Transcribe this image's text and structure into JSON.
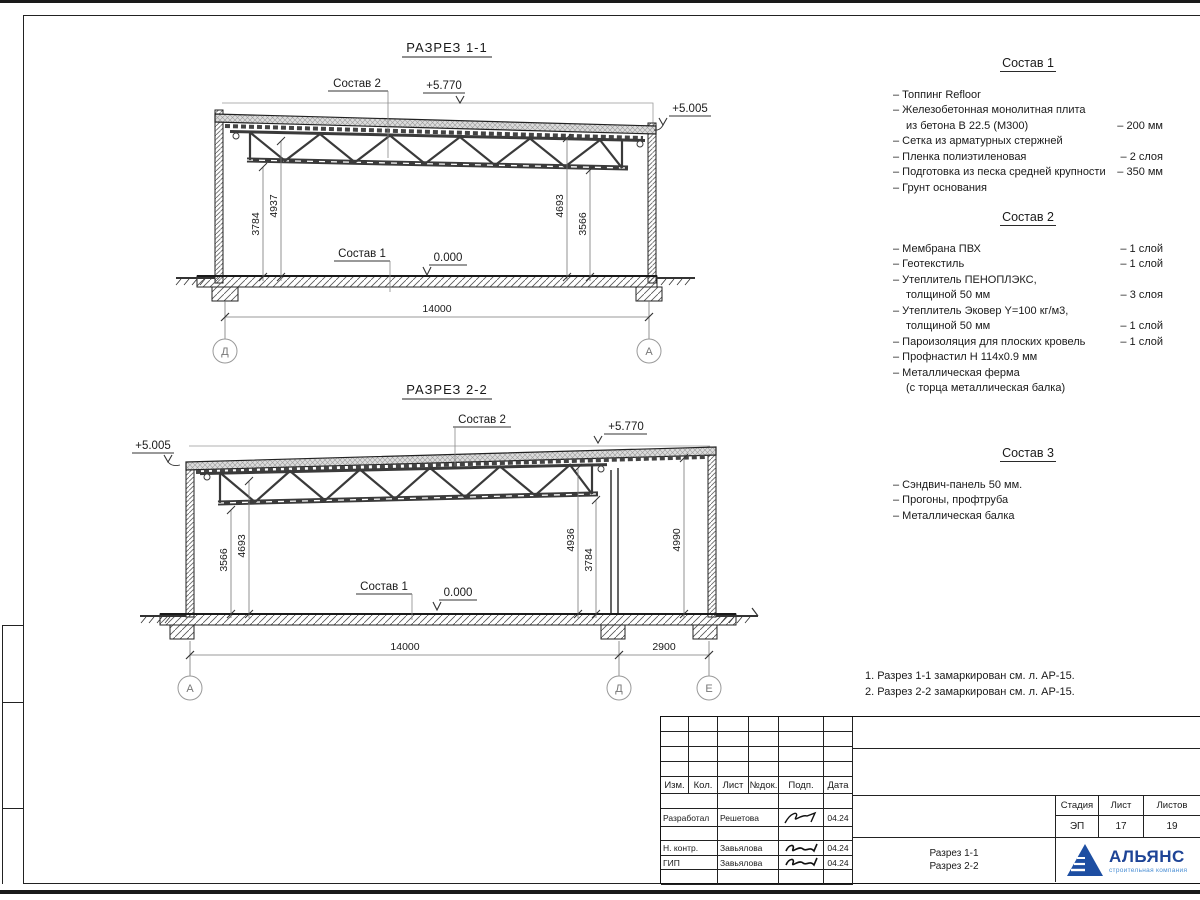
{
  "s1": {
    "title": "РАЗРЕЗ 1-1",
    "label_comp2": "Состав 2",
    "label_comp1": "Состав 1",
    "elev_top": "+5.770",
    "elev_eave": "+5.005",
    "elev_floor": "0.000",
    "dim_left_outer": "3784",
    "dim_left_inner": "4937",
    "dim_right_inner": "4693",
    "dim_right_outer": "3566",
    "dim_span": "14000",
    "axis_left": "Д",
    "axis_right": "А"
  },
  "s2": {
    "title": "РАЗРЕЗ 2-2",
    "label_comp2": "Состав 2",
    "label_comp1": "Состав 1",
    "elev_top": "+5.770",
    "elev_eave": "+5.005",
    "elev_floor": "0.000",
    "dim_left_outer": "3566",
    "dim_left_inner": "4693",
    "dim_mid_inner": "4936",
    "dim_mid_outer": "3784",
    "dim_right": "4990",
    "dim_span": "14000",
    "dim_span2": "2900",
    "axis_left": "А",
    "axis_mid": "Д",
    "axis_right": "Е"
  },
  "comp1": {
    "title": "Состав 1",
    "items": [
      {
        "l1": "– Топпинг Refloor"
      },
      {
        "l1": "– Железобетонная  монолитная плита",
        "l2": "из бетона В 22.5 (М300)",
        "v": "– 200 мм"
      },
      {
        "l1": "– Сетка из арматурных стержней"
      },
      {
        "l1": "– Пленка полиэтиленовая",
        "v": "– 2 слоя"
      },
      {
        "l1": "– Подготовка из песка средней крупности",
        "v": "– 350 мм"
      },
      {
        "l1": "– Грунт основания"
      }
    ]
  },
  "comp2": {
    "title": "Состав 2",
    "items": [
      {
        "l1": "– Мембрана ПВХ",
        "v": "– 1 слой"
      },
      {
        "l1": "– Геотекстиль",
        "v": "– 1 слой"
      },
      {
        "l1": "– Утеплитель ПЕНОПЛЭКС,",
        "l2": "толщиной 50 мм",
        "v": "– 3 слоя"
      },
      {
        "l1": "– Утеплитель Эковер Y=100 кг/м3,",
        "l2": "толщиной 50 мм",
        "v": "– 1 слой"
      },
      {
        "l1": "– Пароизоляция для плоских кровель",
        "v": "– 1 слой"
      },
      {
        "l1": "– Профнастил Н 114х0.9 мм"
      },
      {
        "l1": "– Металлическая ферма",
        "l2": "(с торца металлическая балка)"
      }
    ]
  },
  "comp3": {
    "title": "Состав 3",
    "items": [
      {
        "l1": "– Сэндвич-панель 50 мм."
      },
      {
        "l1": "– Прогоны, профтруба"
      },
      {
        "l1": "– Металлическая балка"
      }
    ]
  },
  "notes": {
    "items": [
      {
        "t": "1. Разрез 1-1 замаркирован см. л. АР-15."
      },
      {
        "t": "2. Разрез 2-2 замаркирован см. л. АР-15."
      }
    ]
  },
  "titleblock": {
    "header_cols": [
      "Изм.",
      "Кол.",
      "Лист",
      "№док.",
      "Подп.",
      "Дата"
    ],
    "rows": [
      {
        "role": "Разработал",
        "name": "Решетова",
        "date": "04.24"
      },
      {
        "role": "Н. контр.",
        "name": "Завьялова",
        "date": "04.24"
      },
      {
        "role": "ГИП",
        "name": "Завьялова",
        "date": "04.24"
      }
    ],
    "doc_title_line1": "Разрез 1-1",
    "doc_title_line2": "Разрез 2-2",
    "stage_label": "Стадия",
    "stage_value": "ЭП",
    "sheet_label": "Лист",
    "sheet_value": "17",
    "sheets_label": "Листов",
    "sheets_value": "19",
    "logo_name": "АЛЬЯНС",
    "logo_subtitle": "строительная компания",
    "logo_color": "#1e4496",
    "logo_subtitle_color": "#4b8fd4"
  }
}
